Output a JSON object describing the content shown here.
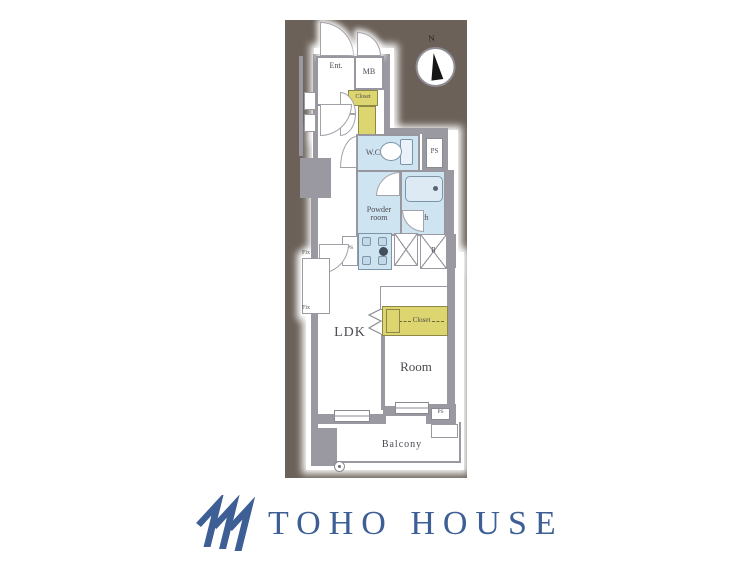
{
  "plan": {
    "labels": {
      "ent": "Ent.",
      "mb": "MB",
      "closet_top": "Closet",
      "wc": "W.C.",
      "ps_top": "PS",
      "powder_room": "Powder room",
      "bath": "Bath",
      "ps_mid": "PS",
      "fridge": "R",
      "ldk": "LDK",
      "closet_lower": "Closet",
      "room": "Room",
      "ps_bottom": "PS",
      "balcony": "Balcony",
      "fix_upper": "Fix",
      "fix_lower": "Fix",
      "compass_north": "N"
    },
    "colors": {
      "panel_background": "#6b6159",
      "wall": "#9a99a1",
      "wet_area": "#cfe4f1",
      "closet": "#ddd56f",
      "fixture_line": "#7d95a8",
      "label_text": "#4b4b52"
    }
  },
  "logo": {
    "text": "TOHO HOUSE",
    "color": "#3d5f95"
  }
}
